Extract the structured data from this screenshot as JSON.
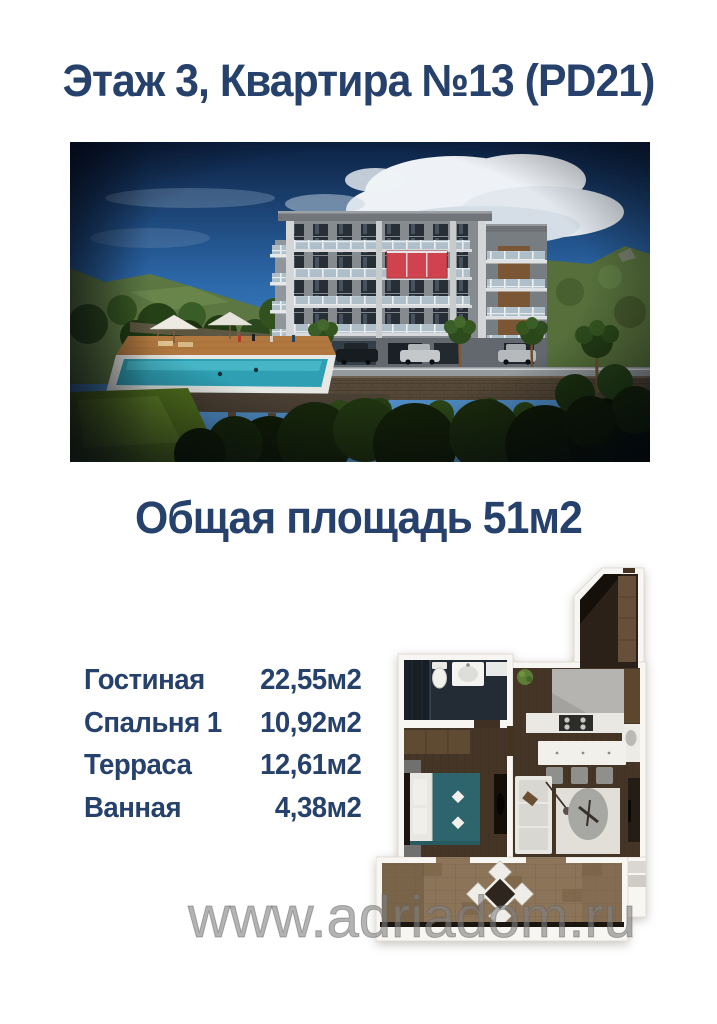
{
  "page": {
    "title": "Этаж 3, Квартира №13 (PD21)",
    "total_area": "Общая площадь 51м2",
    "watermark": "www.adriadom.ru"
  },
  "rooms": [
    {
      "name": "Гостиная",
      "area": "22,55м2"
    },
    {
      "name": "Спальня 1",
      "area": "10,92м2"
    },
    {
      "name": "Терраса",
      "area": "12,61м2"
    },
    {
      "name": "Ванная",
      "area": "4,38м2"
    }
  ],
  "images": {
    "building_render": "apartment-building-exterior-render",
    "floor_plan": "apartment-floor-plan"
  },
  "colors": {
    "heading_navy": "#26416b",
    "highlight_red": "#d0424e",
    "watermark_gray": "#808080",
    "pool_teal": "#2f9fb3"
  }
}
